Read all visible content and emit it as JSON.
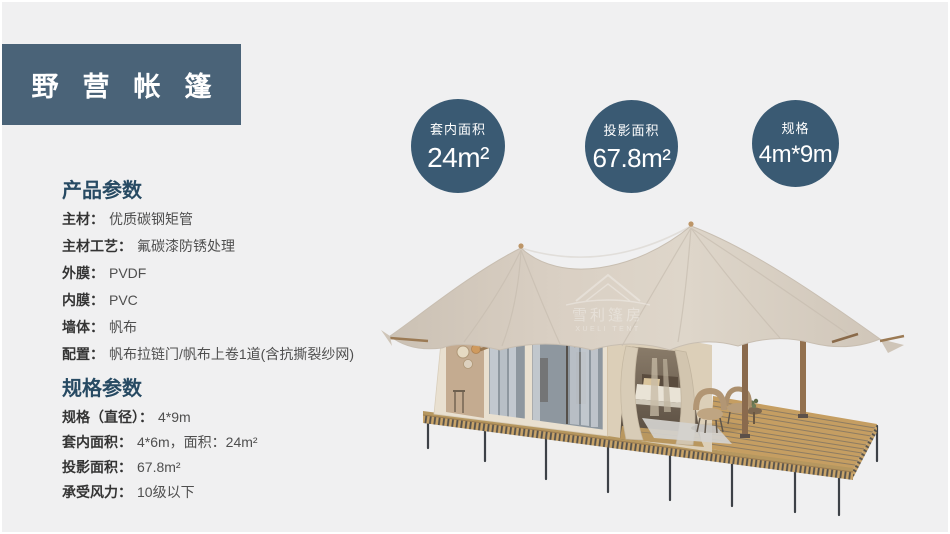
{
  "header": {
    "title": "野营帐篷"
  },
  "stats": [
    {
      "label": "套内面积",
      "value": "24m²"
    },
    {
      "label": "投影面积",
      "value": "67.8m²"
    },
    {
      "label": "规格",
      "value": "4m*9m"
    }
  ],
  "product_params": {
    "heading": "产品参数",
    "items": [
      {
        "label": "主材：",
        "value": "优质碳钢矩管"
      },
      {
        "label": "主材工艺：",
        "value": "氟碳漆防锈处理"
      },
      {
        "label": "外膜：",
        "value": "PVDF"
      },
      {
        "label": "内膜：",
        "value": "PVC"
      },
      {
        "label": "墙体：",
        "value": "帆布"
      },
      {
        "label": "配置：",
        "value": "帆布拉链门/帆布上卷1道(含抗撕裂纱网)"
      }
    ]
  },
  "spec_params": {
    "heading": "规格参数",
    "items": [
      {
        "label": "规格（直径）：",
        "value": "4*9m"
      },
      {
        "label": "套内面积：",
        "value": "4*6m，面积：24m²"
      },
      {
        "label": "投影面积：",
        "value": "67.8m²"
      },
      {
        "label": "承受风力：",
        "value": "10级以下"
      }
    ]
  },
  "watermark": {
    "logo_cn": "雪利篷房",
    "logo_en": "XUELI TENT"
  },
  "colors": {
    "page_background": "#f0f0f1",
    "banner_background": "#4a6378",
    "badge_background": "#3a5a73",
    "heading_text": "#274a63",
    "canopy_fabric": "#d8cec2",
    "deck_wood": "#c59e62"
  }
}
